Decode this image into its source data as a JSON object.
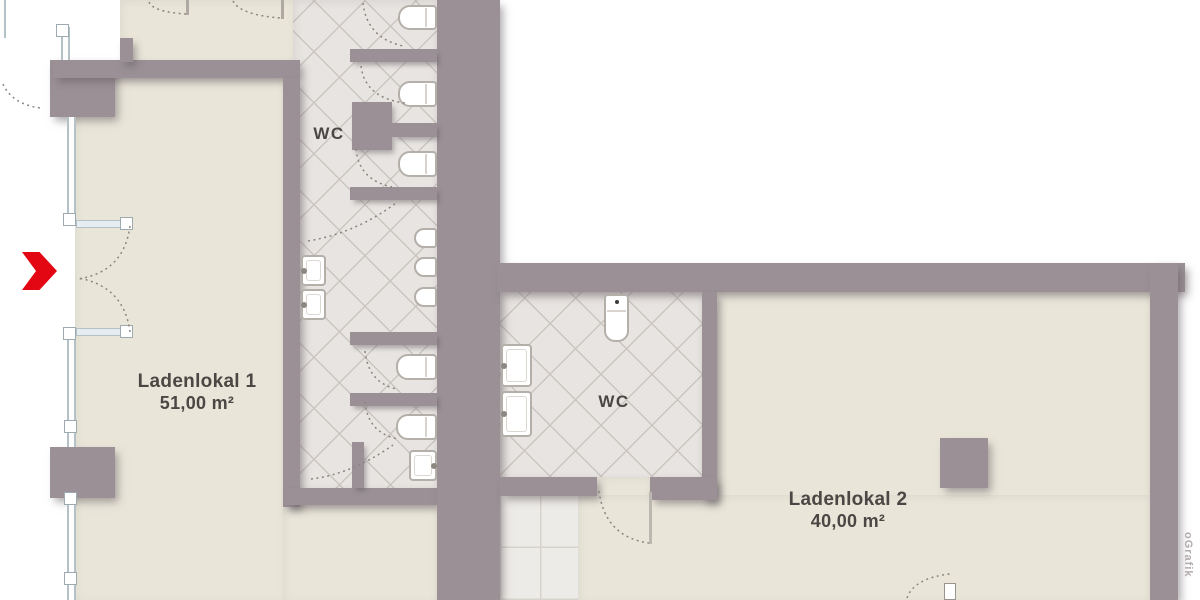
{
  "units": [
    {
      "name": "Ladenlokal 1",
      "area": "51,00 m²"
    },
    {
      "name": "Ladenlokal 2",
      "area": "40,00 m²"
    }
  ],
  "wc_labels": [
    "WC",
    "WC"
  ],
  "watermark": "oGrafik",
  "icons": {
    "entrance_marker": "red-chevron-arrow"
  },
  "colors": {
    "wall": "#9a9096",
    "floor": "#e9e6d9",
    "tile": "#e7e4e1",
    "accent": "#e30613",
    "text": "#4b4744"
  }
}
